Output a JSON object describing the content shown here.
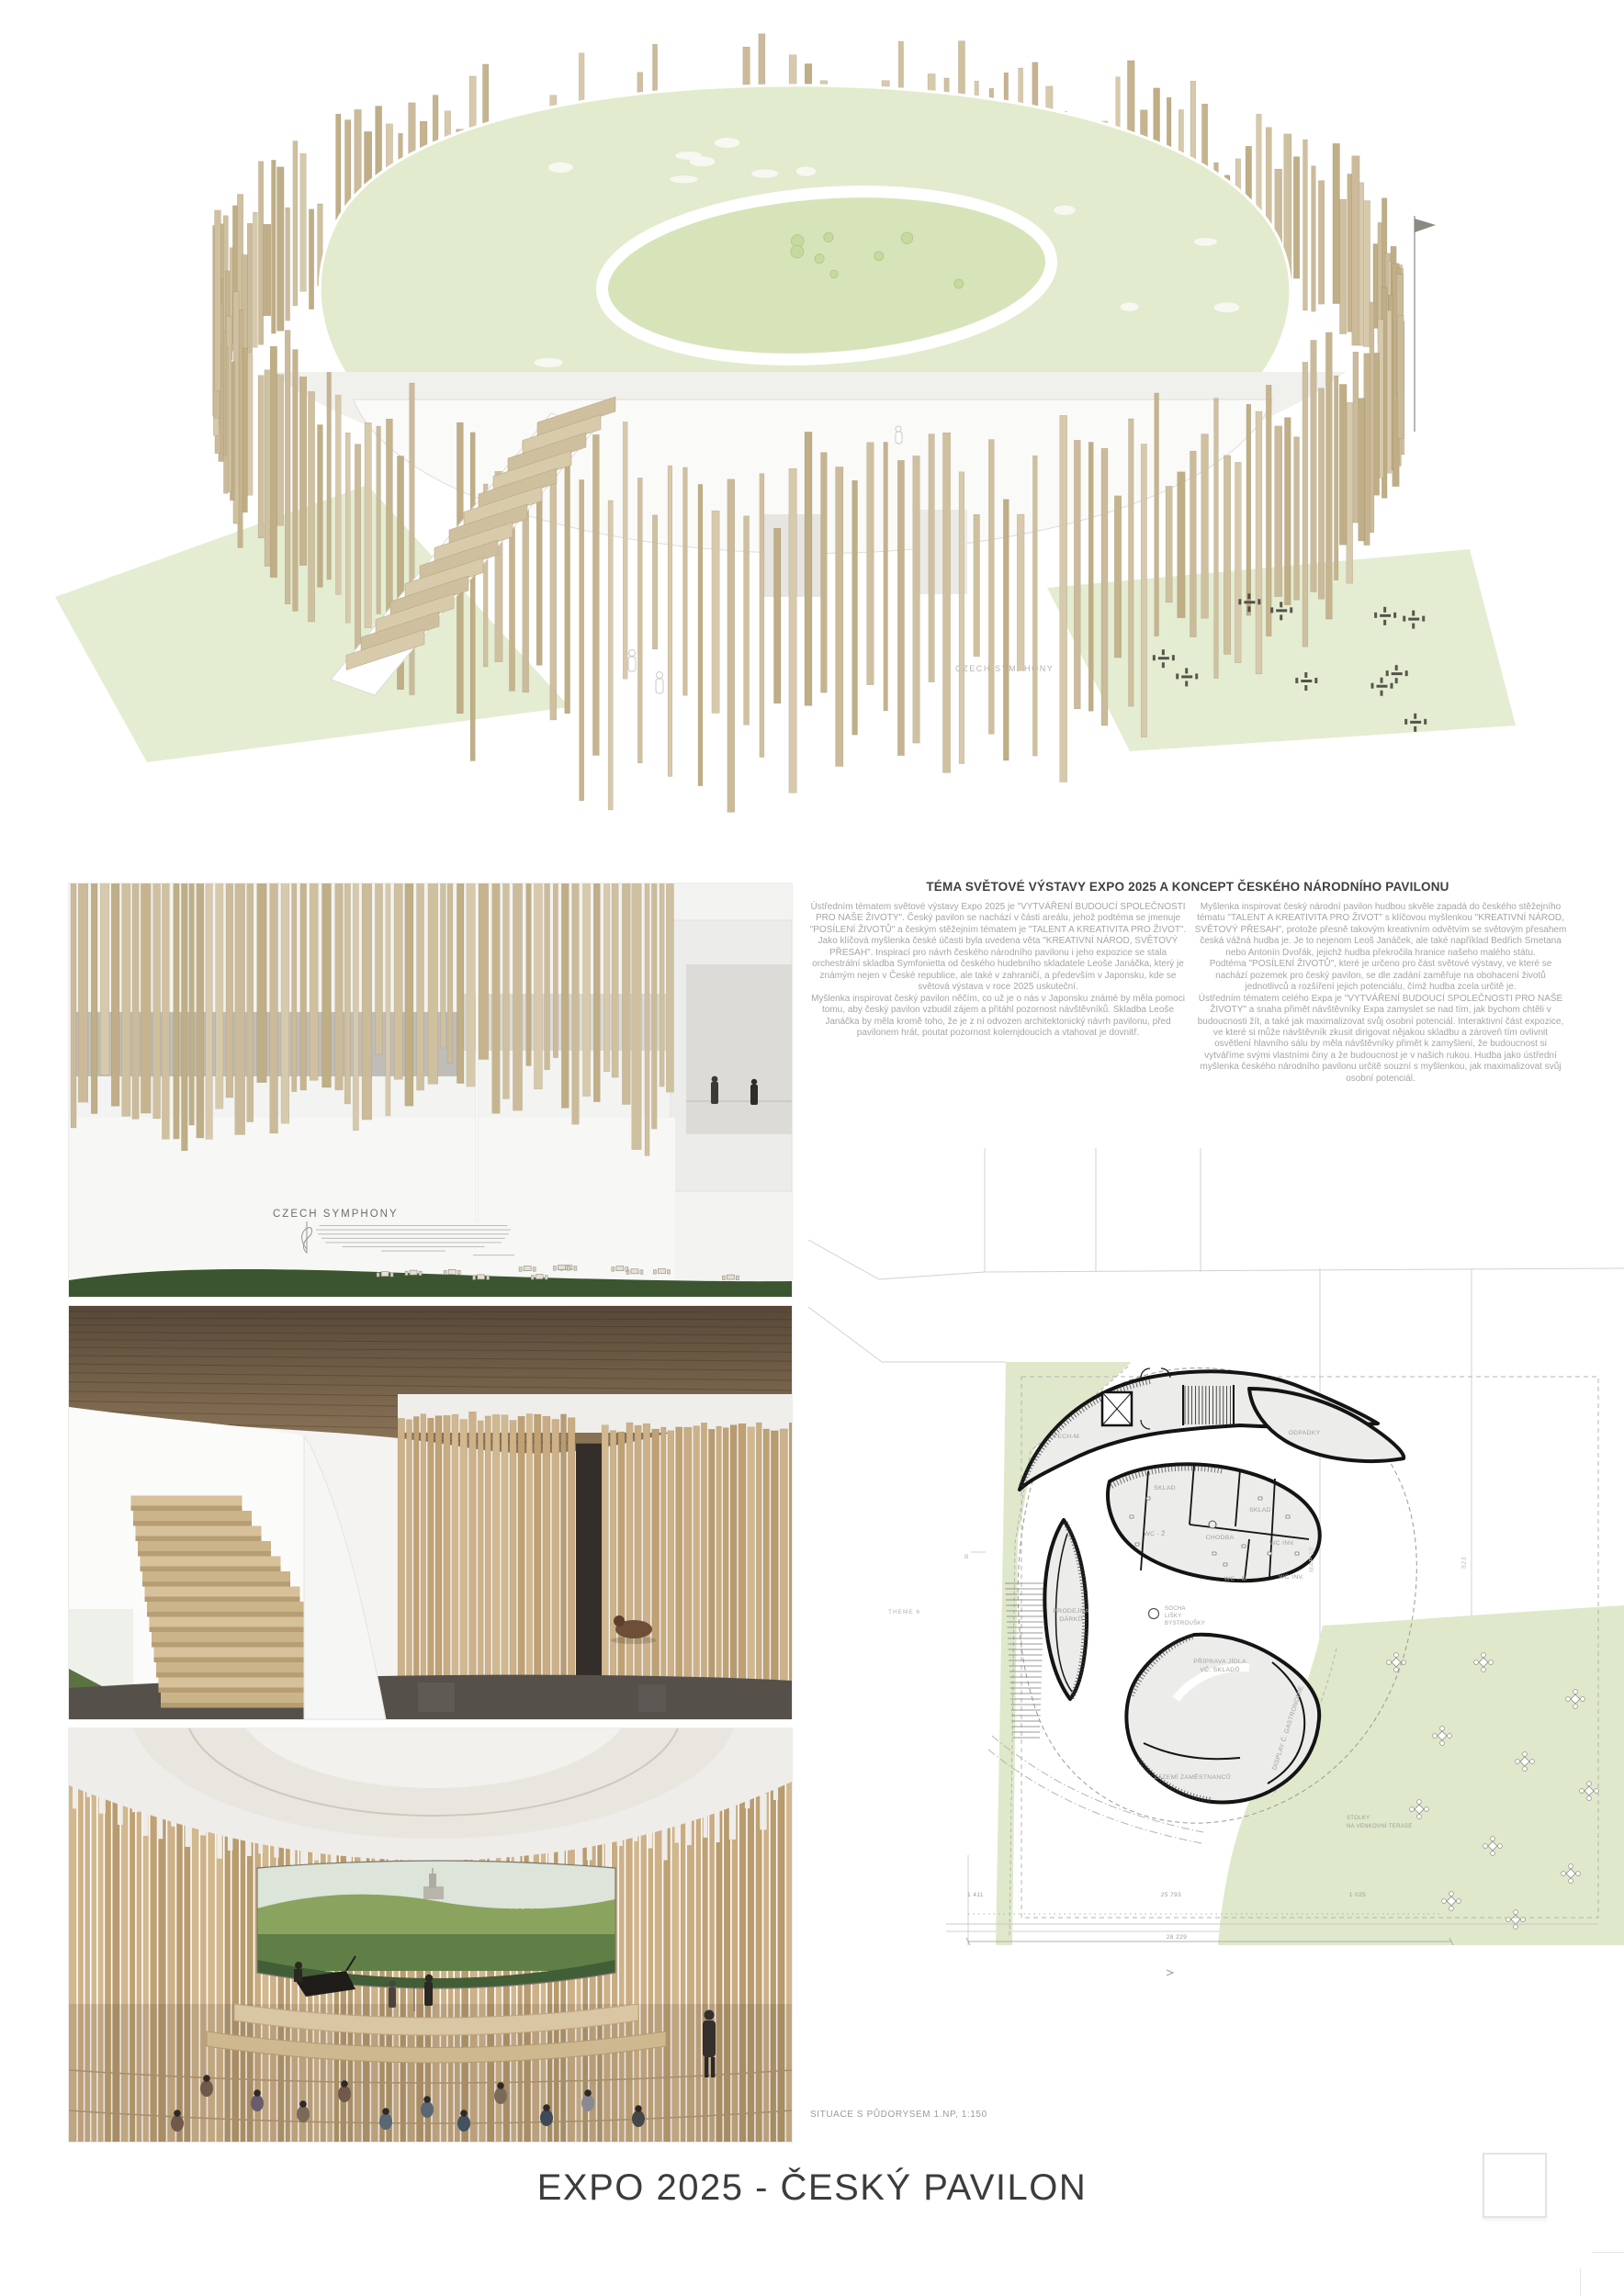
{
  "title": "EXPO 2025 - ČESKÝ PAVILON",
  "hero": {
    "sign": "CZECH SYMPHONY"
  },
  "render1": {
    "sign": "CZECH SYMPHONY"
  },
  "article": {
    "heading": "TÉMA SVĚTOVÉ VÝSTAVY EXPO 2025 A KONCEPT ČESKÉHO NÁRODNÍHO PAVILONU",
    "left": {
      "p1": "Ústředním tématem světové výstavy Expo 2025 je \"VYTVÁŘENÍ BUDOUCÍ SPOLEČNOSTI PRO NAŠE ŽIVOTY\". Český pavilon se nachází v části areálu, jehož podtéma se jmenuje \"POSÍLENÍ ŽIVOTŮ\" a českým stěžejním tématem je \"TALENT A KREATIVITA PRO ŽIVOT\". Jako klíčová myšlenka české účasti byla uvedena věta \"KREATIVNÍ NÁROD, SVĚTOVÝ PŘESAH\". Inspirací pro návrh českého národního pavilonu i jeho expozice se stala orchestrální skladba Symfonietta od českého hudebního skladatele Leoše Janáčka, který je známým nejen v České republice, ale také v zahraničí, a především v Japonsku, kde se světová výstava v roce 2025 uskuteční.",
      "p2": "Myšlenka inspirovat český pavilon něčím, co už je o nás v Japonsku známé by měla pomoci tomu, aby český pavilon vzbudil zájem a přitáhl pozornost návštěvníků. Skladba Leoše Janáčka by měla kromě toho, že je z ní odvozen architektonický návrh pavilonu, před pavilonem hrát, poutat pozornost kolemjdoucích a vtahovat je dovnitř."
    },
    "right": {
      "p1": "Myšlenka inspirovat český národní pavilon hudbou skvěle zapadá do českého stěžejního tématu \"TALENT A KREATIVITA PRO ŽIVOT\" s klíčovou myšlenkou \"KREATIVNÍ NÁROD, SVĚTOVÝ PŘESAH\", protože přesně takovým kreativním odvětvím se světovým přesahem česká vážná hudba je. Je to nejenom Leoš Janáček, ale také například Bedřich Smetana nebo Antonín Dvořák, jejichž hudba překročila hranice našeho malého státu.",
      "p2": "Podtéma \"POSÍLENÍ ŽIVOTŮ\", které je určeno pro část světové výstavy, ve které se nachází pozemek pro český pavilon, se dle zadání zaměřuje na obohacení životů jednotlivců a rozšíření jejich potenciálu, čímž hudba zcela určitě je.",
      "p3": "Ústředním tématem celého Expa je \"VYTVÁŘENÍ BUDOUCÍ SPOLEČNOSTI PRO NAŠE ŽIVOTY\" a snaha přimět návštěvníky Expa zamyslet se nad tím, jak bychom chtěli v budoucnosti žít, a také jak maximalizovat svůj osobní potenciál. Interaktivní část expozice, ve které si může návštěvník zkusit dirigovat nějakou skladbu a zároveň tím ovlivnit osvětlení hlavního sálu by měla návštěvníky přimět k zamyšlení, že budoucnost si vytváříme svými vlastními činy a že budoucnost je v našich rukou. Hudba jako ústřední myšlenka českého národního pavilonu určitě souzní s myšlenkou, jak maximalizovat svůj osobní potenciál."
    }
  },
  "plan": {
    "caption": "SITUACE S PŮDORYSEM 1.NP, 1:150",
    "street": "THEME 6",
    "marker_b": "B",
    "lot_a": "MAP 10",
    "lot_b": "823",
    "rooms": {
      "tech": "TECH-M.",
      "odpadky": "ODPADKY",
      "sklad1": "SKLAD",
      "sklad2": "SKLAD",
      "wc_z": "WC - Ž",
      "chodba": "CHODBA",
      "wc_inv1": "WC INV.",
      "wc_m": "WC - M",
      "wc_inv2": "WC INV.",
      "prodejna1": "PRODEJNA",
      "prodejna2": "DÁRKŮ",
      "priprava1": "PŘÍPRAVA JÍDLA",
      "priprava2": "VČ. SKLADŮ",
      "display": "DISPLAY Č. GASTRONOMIE",
      "zazemi": "ZÁZEMÍ ZAMĚSTNANCŮ"
    },
    "legend": {
      "l1": "SOCHA",
      "l2": "LIŠKY",
      "l3": "BYSTROUŠKY"
    },
    "terrace": {
      "l1": "STOLKY",
      "l2": "NA VENKOVNÍ TERASE"
    },
    "dims": {
      "d1": "1 411",
      "d2": "25 793",
      "d3": "1 025",
      "total": "28 229"
    }
  },
  "colors": {
    "wood": "#c9b592",
    "roof_green": "#e2ebcd",
    "site_green": "#dfe8ca",
    "grass": "#3c5531",
    "wall_line": "#141414"
  }
}
